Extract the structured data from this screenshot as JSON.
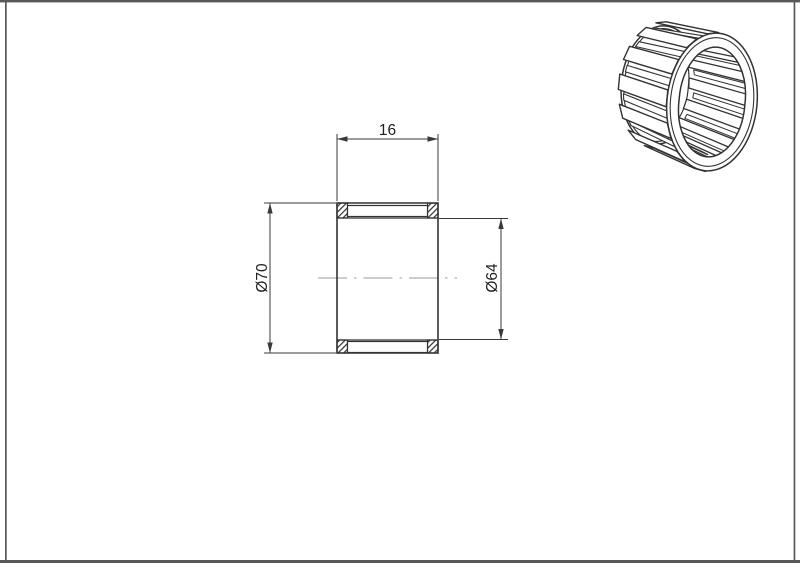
{
  "page": {
    "background": "#ffffff",
    "frame_color": "#58585a"
  },
  "drawing": {
    "dimensions": {
      "width": {
        "label": "16"
      },
      "outer_diameter": {
        "label": "Ø70"
      },
      "bore_diameter": {
        "label": "Ø64"
      }
    },
    "colors": {
      "outline": "#333333",
      "dimension": "#3a3a3a",
      "centerline": "#9a9a9a",
      "hatch": "#2f2f2f"
    }
  }
}
